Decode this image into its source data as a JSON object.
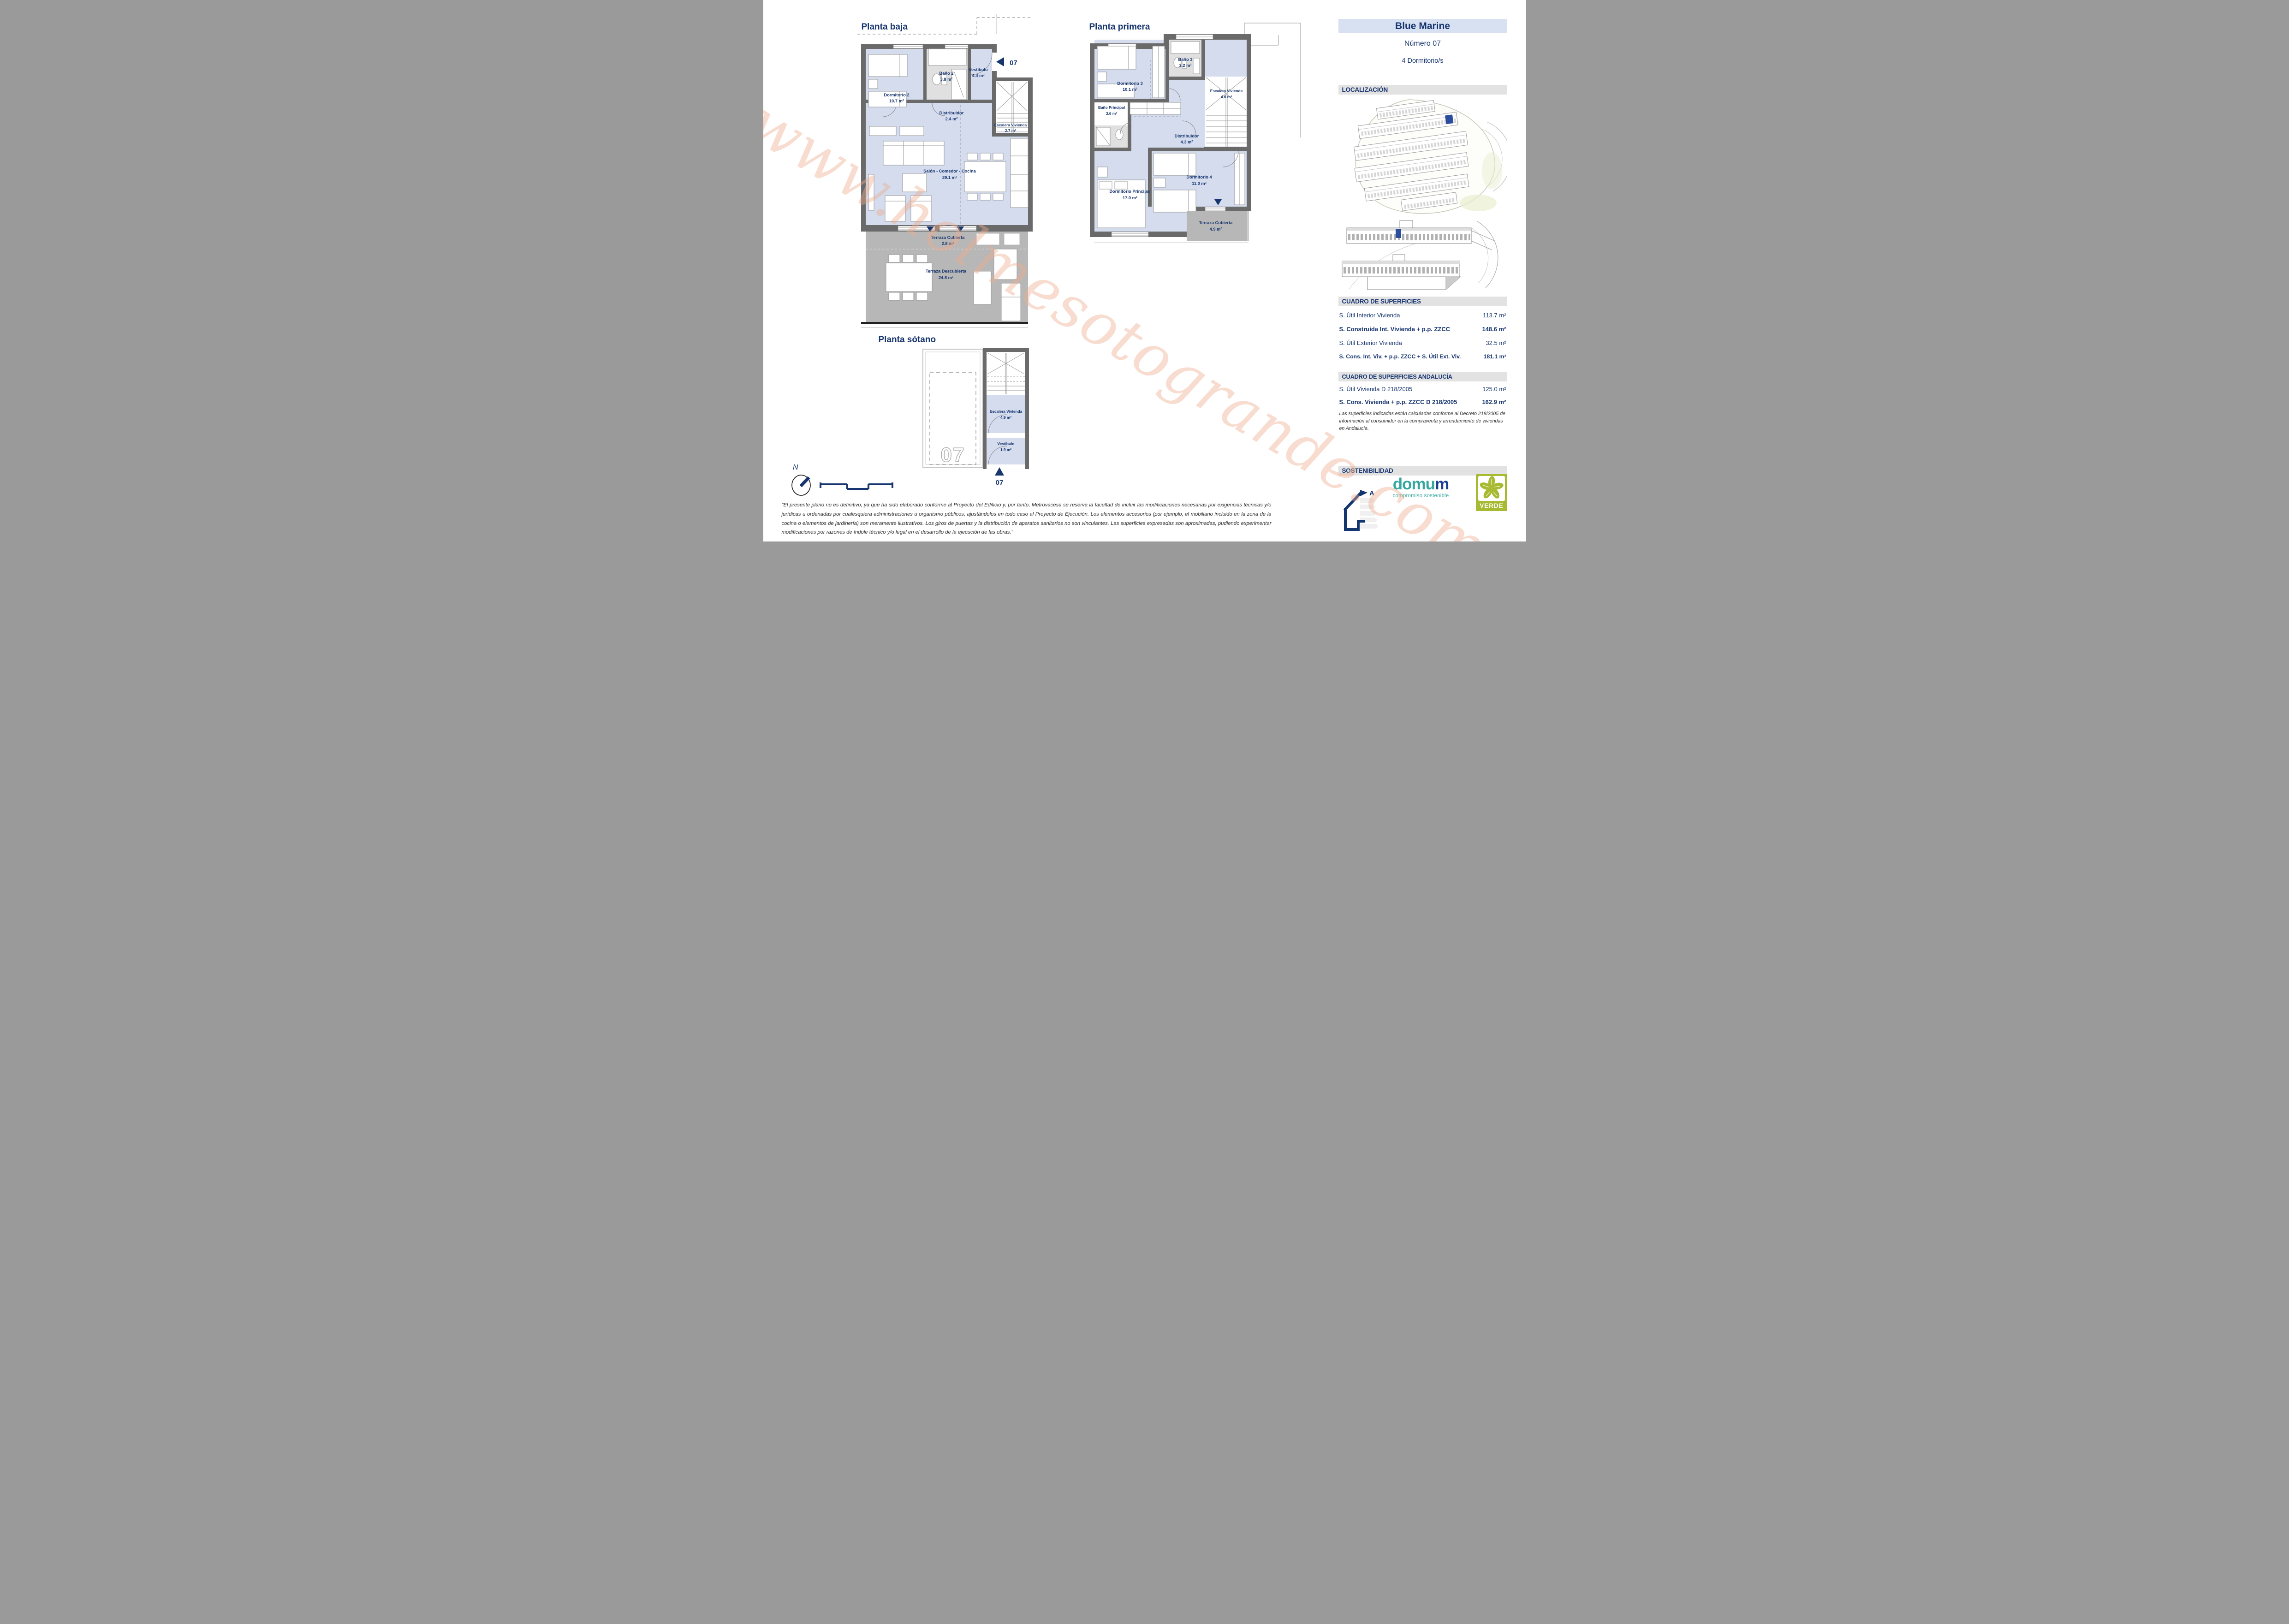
{
  "watermark": "www.holmesotogrande.com",
  "colors": {
    "accent_navy": "#17356f",
    "header_bg": "#d8e1f2",
    "section_bar_bg": "#e2e2e2",
    "room_blue": "#d4dcee",
    "bath_gray": "#e0e0e0",
    "terrace_gray": "#b7b7b7",
    "wall_gray": "#6a6a6a",
    "highlight_blue": "#2b4d9e",
    "domum_teal": "#35a79f",
    "verde_green": "#a8b932"
  },
  "plans": {
    "planta_baja": {
      "title": "Planta baja",
      "unit_marker": "07",
      "rooms": [
        {
          "name": "Dormitorio 2",
          "area": "10.7 m²"
        },
        {
          "name": "Baño 2",
          "area": "3.8 m²"
        },
        {
          "name": "Vestíbulo",
          "area": "4.4 m²"
        },
        {
          "name": "Distribuidor",
          "area": "2.4 m²"
        },
        {
          "name": "Escalera Vivienda",
          "area": "2.7 m²"
        },
        {
          "name": "Salón - Comedor - Cocina",
          "area": "29.1 m²"
        },
        {
          "name": "Terraza Cubierta",
          "area": "2.8 m²"
        },
        {
          "name": "Terraza Descubierta",
          "area": "24.8 m²"
        }
      ]
    },
    "planta_primera": {
      "title": "Planta primera",
      "rooms": [
        {
          "name": "Dormitorio 3",
          "area": "10.1 m²"
        },
        {
          "name": "Baño 3",
          "area": "3.2 m²"
        },
        {
          "name": "Escalera Vivienda",
          "area": "4.6 m²"
        },
        {
          "name": "Baño Principal",
          "area": "3.6 m²"
        },
        {
          "name": "Distribuidor",
          "area": "4.3 m²"
        },
        {
          "name": "Dormitorio 4",
          "area": "11.0 m²"
        },
        {
          "name": "Dormitorio Principal",
          "area": "17.0 m²"
        },
        {
          "name": "Terraza Cubierta",
          "area": "4.9 m²"
        }
      ]
    },
    "planta_sotano": {
      "title": "Planta sótano",
      "unit_marker": "07",
      "garage_number": "07",
      "rooms": [
        {
          "name": "Escalera Vivienda",
          "area": "4.9 m²"
        },
        {
          "name": "Vestíbulo",
          "area": "1.9 m²"
        }
      ]
    }
  },
  "compass": {
    "north_label": "N"
  },
  "sidebar": {
    "project": "Blue Marine",
    "unit": "Número 07",
    "bedrooms": "4 Dormitorio/s",
    "localizacion_title": "LOCALIZACIÓN",
    "superficies": {
      "title": "CUADRO DE SUPERFICIES",
      "rows": [
        {
          "label": "S. Útil Interior Vivienda",
          "value": "113.7 m²"
        },
        {
          "label": "S. Construida Int. Vivienda + p.p. ZZCC",
          "value": "148.6 m²"
        },
        {
          "label": "S. Útil Exterior Vivienda",
          "value": "32.5 m²"
        },
        {
          "label": "S. Cons. Int. Viv. + p.p. ZZCC + S. Útil Ext. Viv.",
          "value": "181.1 m²"
        }
      ]
    },
    "superficies_andalucia": {
      "title": "CUADRO DE SUPERFICIES ANDALUCÍA",
      "rows": [
        {
          "label": "S. Útil Vivienda D 218/2005",
          "value": "125.0 m²"
        },
        {
          "label": "S. Cons. Vivienda + p.p. ZZCC D 218/2005",
          "value": "162.9 m²"
        }
      ],
      "note": "Las superficies indicadas están calculadas conforme al Decreto 218/2005 de información al consumidor en la compraventa y arrendamiento de viviendas en Andalucía."
    },
    "sostenibilidad": {
      "title": "SOSTENIBILIDAD",
      "energy_letter": "A",
      "domum_part1": "domu",
      "domum_part2": "m",
      "domum_tagline": "compromiso sostenible",
      "verde_label": "VERDE"
    }
  },
  "disclaimer": "\"El presente plano no es definitivo, ya que ha sido elaborado conforme al Proyecto del Edificio y, por tanto, Metrovacesa se reserva la facultad de incluir las modificaciones necesarias por exigencias técnicas y/o jurídicas u ordenadas por cualesquiera administraciones u organismo públicos, ajustándolos en todo caso al Proyecto de Ejecución. Los elementos accesorios (por ejemplo, el mobiliario incluido en la zona de la cocina o elementos de jardinería) son meramente ilustrativos. Los giros de puertas y la distribución de aparatos sanitarios no son vinculantes. Las superficies expresadas son aproximadas, pudiendo experimentar modificaciones por razones de índole técnico y/o legal en el desarrollo de la ejecución de las obras.\""
}
